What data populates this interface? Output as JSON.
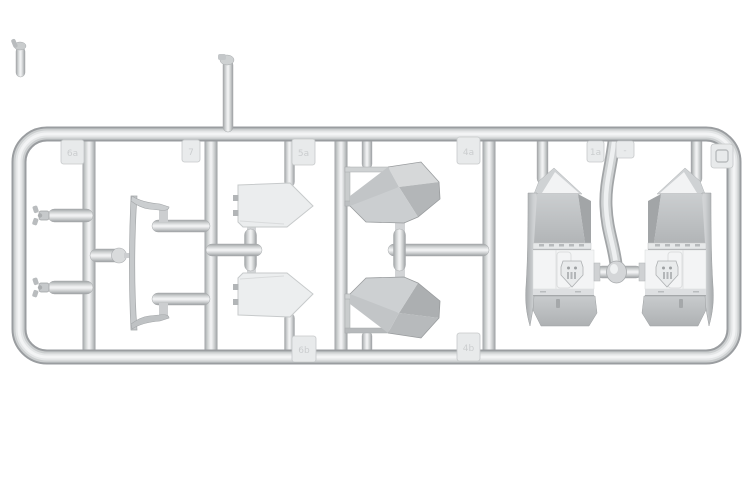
{
  "scene": {
    "subject": "Light gray plastic model kit sprue (injection-molded parts tree) on white background",
    "background": "#ffffff"
  },
  "colors": {
    "plastic_base": "#d4d6d8",
    "plastic_highlight": "#f2f3f4",
    "plastic_shadow": "#a2a5a7",
    "panel_white": "#f3f4f5",
    "facet_dark": "#9ea1a3",
    "pane_light": "#ebedee"
  },
  "tabs": [
    {
      "id": "tab-top-1",
      "mark": "6a"
    },
    {
      "id": "tab-top-2",
      "mark": "7"
    },
    {
      "id": "tab-top-3",
      "mark": "5a"
    },
    {
      "id": "tab-top-4",
      "mark": "4a"
    },
    {
      "id": "tab-top-5",
      "mark": "1a"
    },
    {
      "id": "tab-top-6",
      "mark": "-"
    },
    {
      "id": "tab-top-7",
      "mark": ""
    },
    {
      "id": "tab-bottom-1",
      "mark": "6b"
    },
    {
      "id": "tab-bottom-2",
      "mark": "4b"
    }
  ]
}
